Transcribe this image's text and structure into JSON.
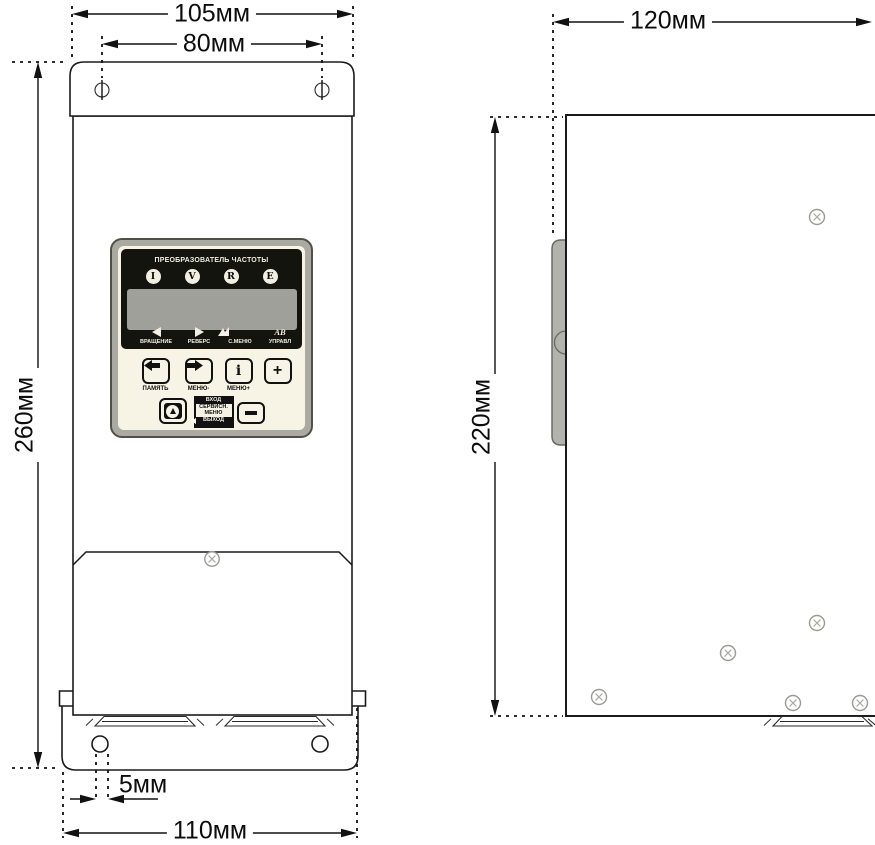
{
  "front_view": {
    "dims": {
      "overall_width": "105мм",
      "mount_hole_spacing": "80мм",
      "overall_height": "260мм",
      "bottom_hole_offset": "5мм",
      "bottom_width": "110мм"
    },
    "keypad": {
      "title": "ПРЕОБРАЗОВАТЕЛЬ ЧАСТОТЫ",
      "indicators": [
        "I",
        "V",
        "R",
        "E"
      ],
      "status_labels": [
        "ВРАЩЕНИЕ",
        "РЕВЕРС",
        "С.МЕНЮ",
        "УПРАВЛ"
      ],
      "control_icon_text": "АВ",
      "btn_memory_label": "ПАМЯТЬ",
      "btn_menu_minus_label": "МЕНЮ-",
      "btn_menu_plus_label": "МЕНЮ+",
      "glyph_info": "i",
      "glyph_plus": "+",
      "mode_lines": [
        "ВХОД",
        "СЕРВИСН.",
        "МЕНЮ",
        "ВЫХОД"
      ]
    }
  },
  "side_view": {
    "dims": {
      "depth": "120мм",
      "body_height": "220мм"
    }
  },
  "colors": {
    "bezel_gray": "#aaaaa2",
    "panel_black": "#14140f",
    "lcd_gray": "#a0a09a",
    "cream": "#f7f3e5",
    "line": "#111111"
  }
}
